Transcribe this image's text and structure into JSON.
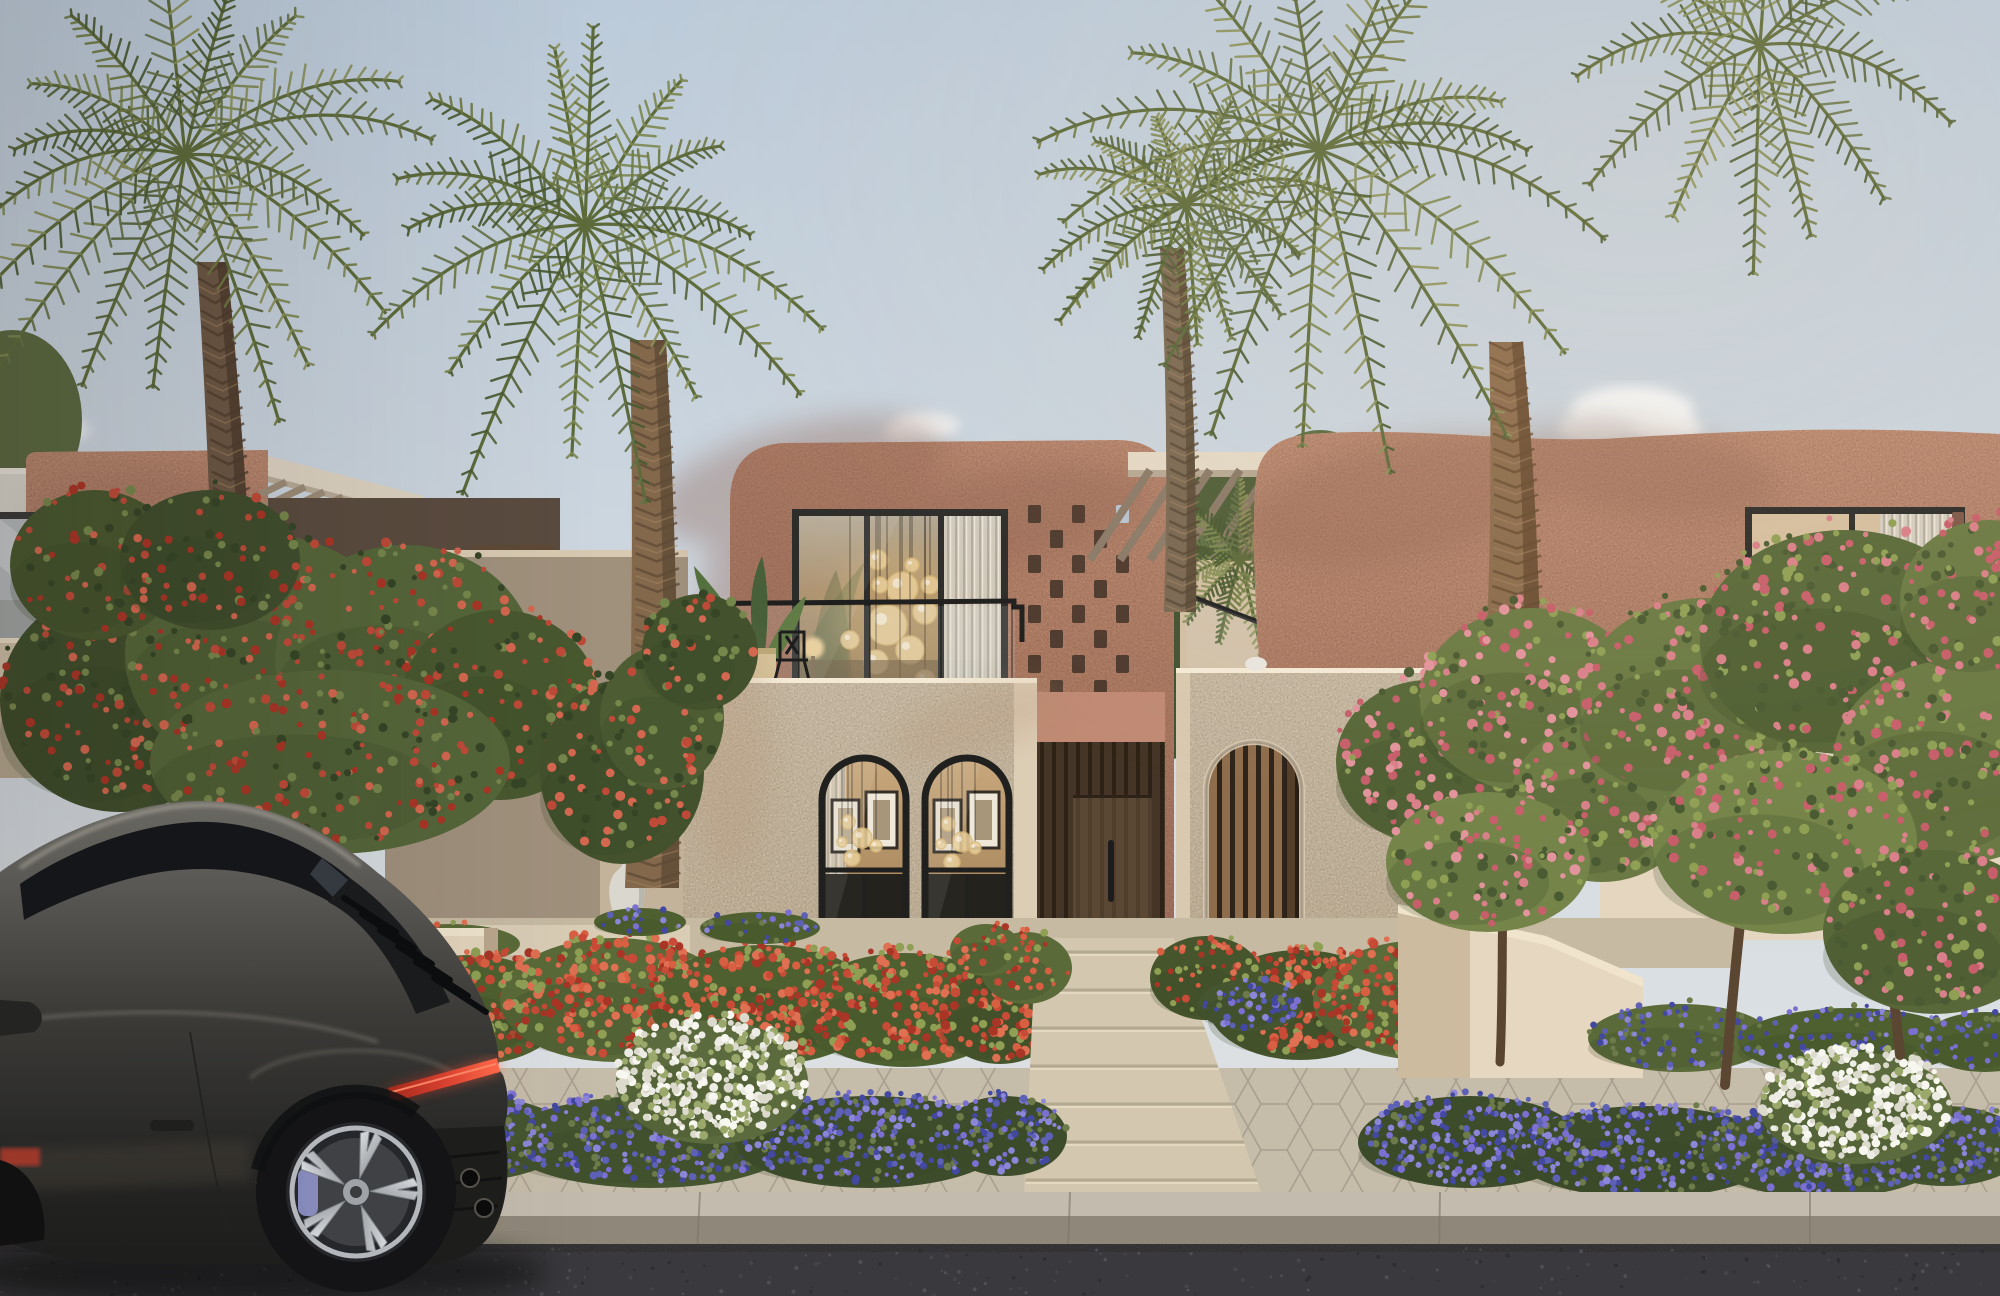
{
  "scene": {
    "type": "architectural-exterior-rendering",
    "description": "Late-afternoon photorealistic render of a two-storey desert-modern villa street front: pink stucco upper volumes with mashrabiya brick lattices, cream plastered entry volumes with two black-framed arched windows and an arched timber-slat screen, timber entry door, glass balconies, date palms, flowering shrubs, paved walkway, sidewalk flower beds, asphalt road and a dark grey sports coupe parked at the curb.",
    "time_of_day": "golden hour",
    "weather": "clear sky with small clouds"
  },
  "objects": {
    "villas": 3,
    "palm_trees": 5,
    "arched_windows": 2,
    "arched_slat_screens": 1,
    "entry_doors": 1,
    "lattice_panels": 3,
    "balcony_railings": 4,
    "pergolas": 2,
    "flower_beds_red": 3,
    "flower_beds_purple": 4,
    "white_flower_bushes": 4,
    "flowering_trees": 2,
    "decorative_vases": 1,
    "sports_cars": 1
  },
  "palette": {
    "sky_top": "#bccbda",
    "sky_horizon": "#dadfe3",
    "cloud": "#f4f6f7",
    "pink_lit": "#d7a189",
    "pink_mid": "#c79078",
    "pink_shadow": "#a87865",
    "cream_block": "#ece1cc",
    "cream_side": "#d9cab2",
    "beige_wall": "#cdbfa7",
    "wall_shadow": "#b3a48f",
    "wood_dark": "#4a392b",
    "wood_mid": "#6a5440",
    "wood_slat": "#a8815a",
    "frame_black": "#2b2b29",
    "glass_cool": "#b3b8bb",
    "glass_warm": "#b3905f",
    "chandelier_gold": "#e9cf9b",
    "leaf_dark": "#45542f",
    "leaf_mid": "#5d6c3c",
    "leaf_light": "#7f8c52",
    "palm_olive": "#6f7a44",
    "trunk": "#83684c",
    "trunk_shadow": "#5e4a36",
    "flower_red": "#c84b37",
    "flower_coral": "#df7052",
    "flower_pink": "#d77e86",
    "flower_purple": "#5c61b6",
    "flower_violet": "#7b70d2",
    "flower_white": "#edece4",
    "paver": "#cdc2ad",
    "walkway": "#d3c7b0",
    "sidewalk": "#c6bcaa",
    "curb_top": "#c3bcae",
    "curb_face": "#8f887a",
    "asphalt": "#3a3a3e",
    "car_top": "#5a5854",
    "car_mid": "#3c3b38",
    "car_dark": "#242423",
    "car_glass": "#15161a",
    "taillight_red": "#d6402f",
    "wheel_silver": "#c6c9cd",
    "brake_caliper": "#8f94c9"
  }
}
